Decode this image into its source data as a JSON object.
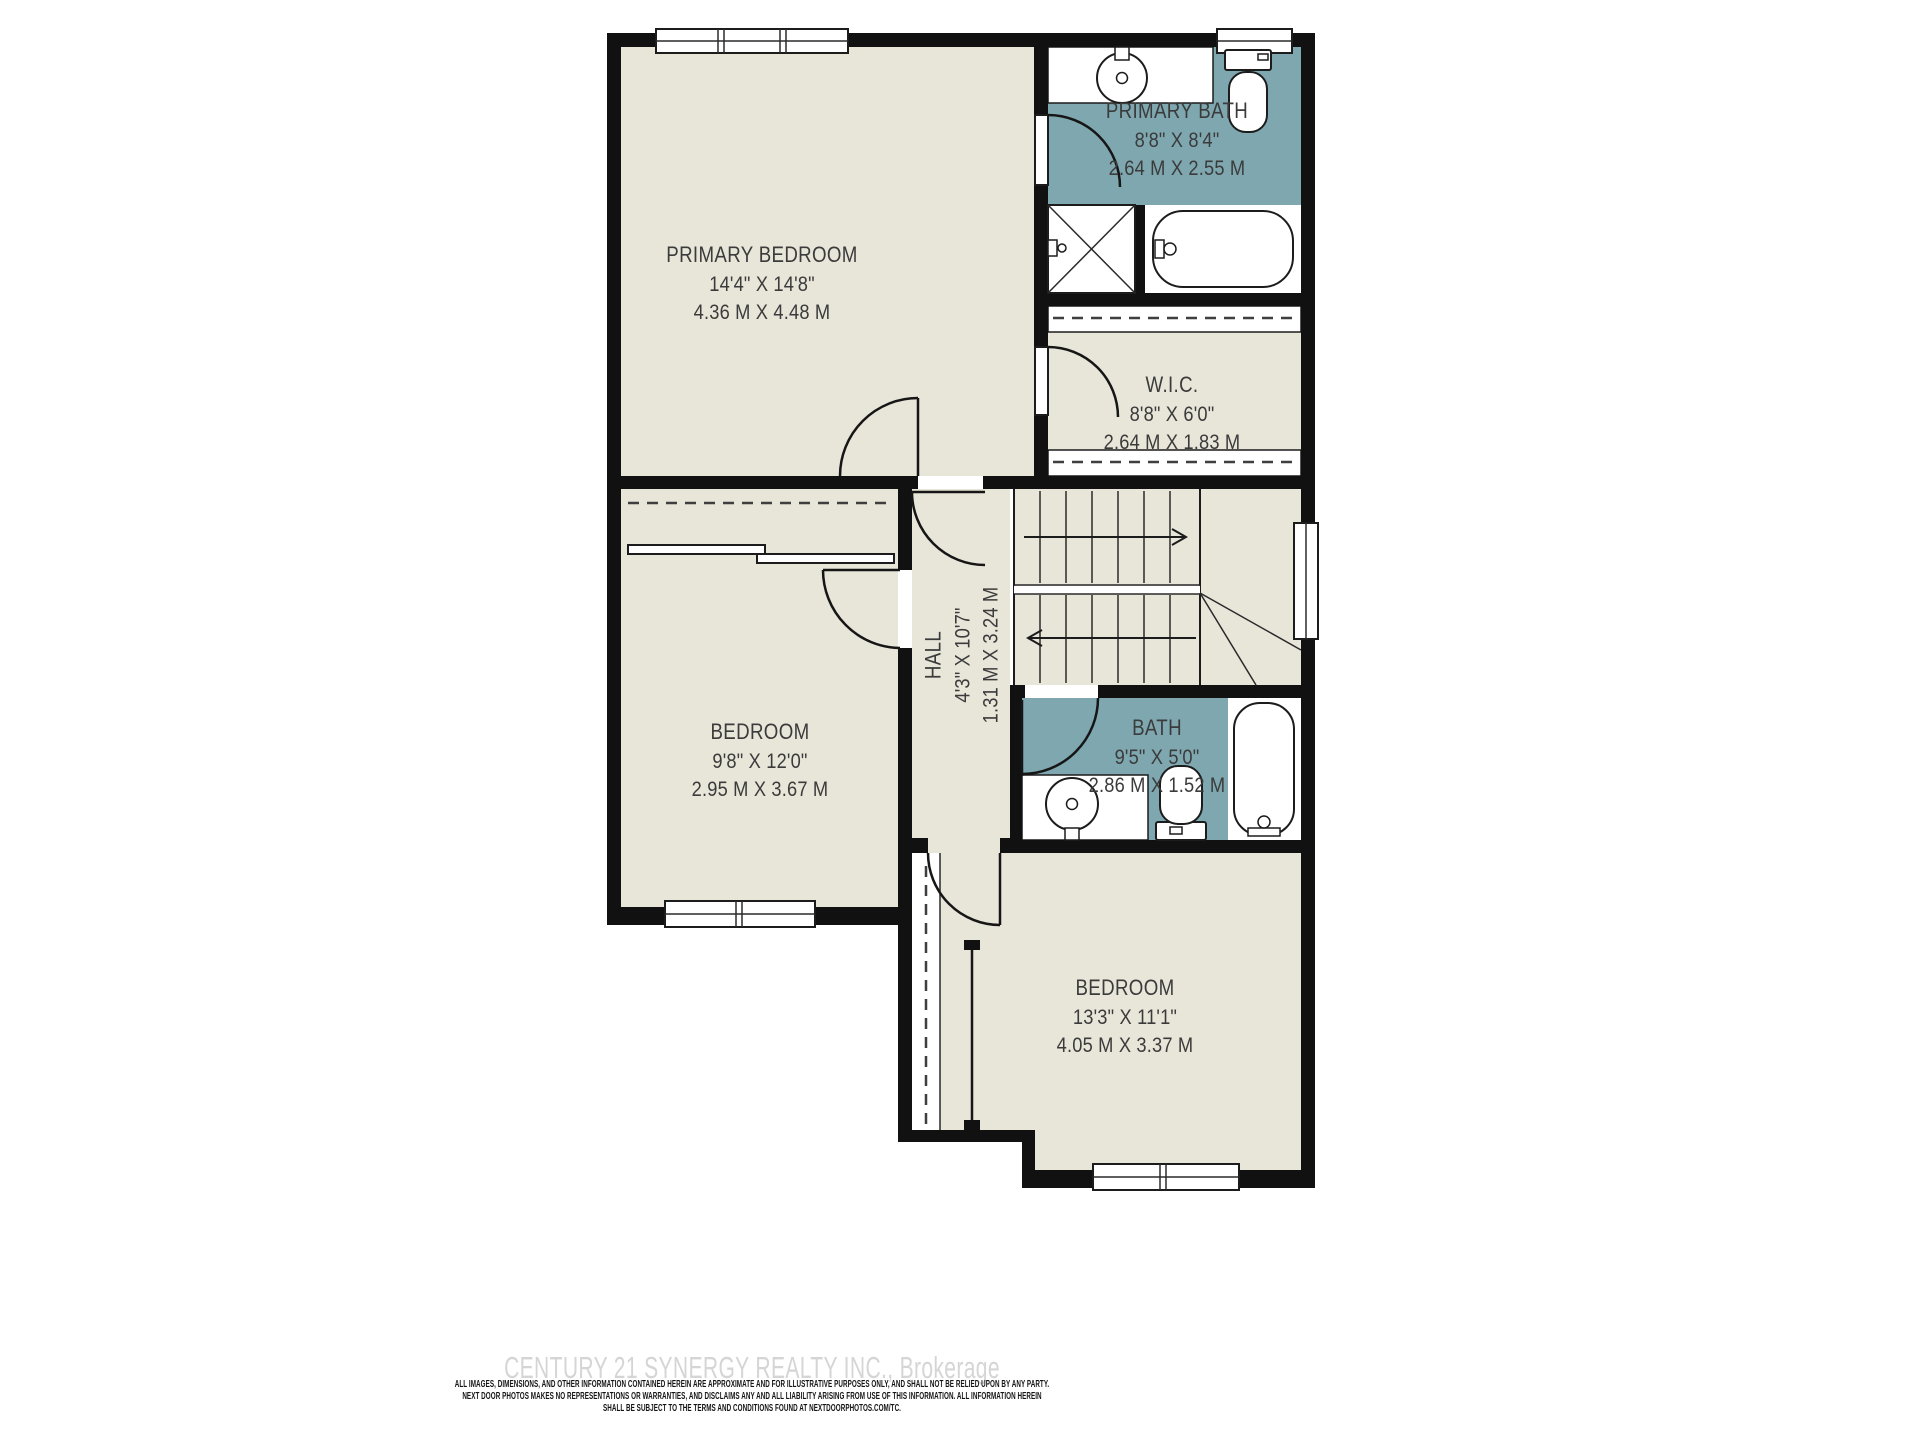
{
  "plan": {
    "rooms": {
      "primary_bedroom": {
        "name": "PRIMARY BEDROOM",
        "imperial": "14'4\" X 14'8\"",
        "metric": "4.36 M X 4.48 M"
      },
      "primary_bath": {
        "name": "PRIMARY BATH",
        "imperial": "8'8\" X 8'4\"",
        "metric": "2.64 M X 2.55 M"
      },
      "wic": {
        "name": "W.I.C.",
        "imperial": "8'8\" X 6'0\"",
        "metric": "2.64 M X 1.83 M"
      },
      "hall": {
        "name": "HALL",
        "imperial": "4'3\" X 10'7\"",
        "metric": "1.31 M X 3.24 M"
      },
      "bedroom_left": {
        "name": "BEDROOM",
        "imperial": "9'8\" X 12'0\"",
        "metric": "2.95 M X 3.67 M"
      },
      "bath": {
        "name": "BATH",
        "imperial": "9'5\" X 5'0\"",
        "metric": "2.86 M X 1.52 M"
      },
      "bedroom_bottom": {
        "name": "BEDROOM",
        "imperial": "13'3\" X 11'1\"",
        "metric": "4.05 M X 3.37 M"
      }
    }
  },
  "footer": {
    "watermark": "CENTURY 21 SYNERGY REALTY INC., Brokerage",
    "disclaimer_lines": [
      "ALL IMAGES, DIMENSIONS, AND OTHER INFORMATION CONTAINED HEREIN ARE APPROXIMATE AND FOR ILLUSTRATIVE PURPOSES ONLY, AND SHALL NOT BE RELIED UPON BY ANY PARTY.",
      "NEXT DOOR PHOTOS MAKES NO REPRESENTATIONS OR WARRANTIES, AND DISCLAIMS ANY AND ALL LIABILITY ARISING FROM USE OF THIS INFORMATION. ALL INFORMATION HEREIN",
      "SHALL BE SUBJECT TO THE TERMS AND CONDITIONS FOUND AT NEXTDOORPHOTOS.COM/TC."
    ]
  },
  "colors": {
    "room_fill": "#e8e5d9",
    "bath_fill": "#7ea7b0",
    "wall": "#111111",
    "label_text": "#3b3b3b",
    "watermark_text": "#d5d5d5"
  }
}
